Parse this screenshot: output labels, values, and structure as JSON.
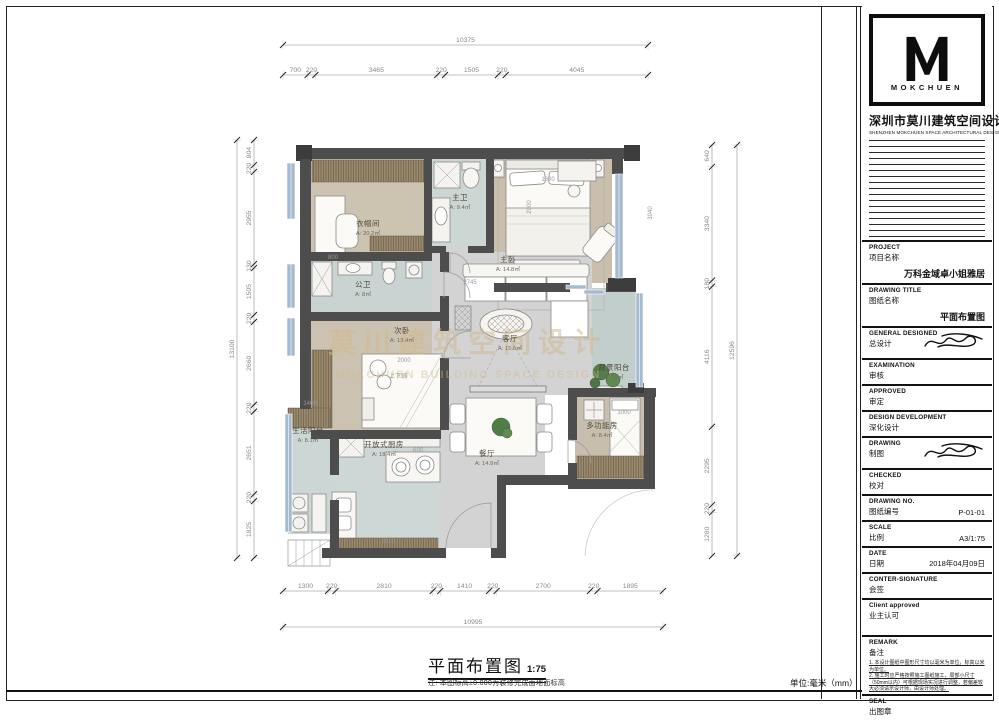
{
  "sheet": {
    "company": {
      "logo_letter": "M",
      "logo_word": "MOKCHUEN",
      "name_cn": "深圳市莫川建筑空间设计",
      "name_en": "SHENZHEN MOKCHUEN SPACE ARCHITECTURAL DESIGN"
    },
    "footer": {
      "title": "平面布置图",
      "scale": "1:75",
      "note": "注: 本图标高±0.000为装修完成面地面标高",
      "unit": "单位:毫米（mm）"
    },
    "watermark": {
      "cn": "莫川建筑空间设计",
      "en": "MOKCHUEN BUILDING SPACE DESIGN"
    },
    "colors": {
      "wall": "#4d4d4d",
      "bedroom_floor": "#cbc1ae",
      "wet_floor": "#ccd6d3",
      "living_floor": "#d3d3d4",
      "window_glass": "#a3bad0",
      "wood": "#9b8a6e",
      "watermark": "#d2b98b"
    }
  },
  "titleblock": {
    "rows": [
      {
        "en": "PROJECT",
        "cn": "项目名称",
        "value": "万科金域卓小姐雅居",
        "tall": true
      },
      {
        "en": "DRAWING TITLE",
        "cn": "图纸名称",
        "value": "平面布置图",
        "tall": true
      },
      {
        "en": "GENERAL  DESIGNED",
        "cn": "总设计",
        "value": "",
        "sig": true
      },
      {
        "en": "EXAMINATION",
        "cn": "审核",
        "value": ""
      },
      {
        "en": "APPROVED",
        "cn": "审定",
        "value": ""
      },
      {
        "en": "DESIGN DEVELOPMENT",
        "cn": "深化设计",
        "value": ""
      },
      {
        "en": "DRAWING",
        "cn": "制图",
        "value": "",
        "sig": true
      },
      {
        "en": "CHECKED",
        "cn": "校对",
        "value": ""
      },
      {
        "en": "DRAWING NO.",
        "cn": "图纸编号",
        "value": "P-01-01"
      },
      {
        "en": "SCALE",
        "cn": "比例",
        "value": "A3/1:75"
      },
      {
        "en": "DATE",
        "cn": "日期",
        "value": "2018年04月09日"
      },
      {
        "en": "CONTER-SIGNATURE",
        "cn": "会签",
        "value": ""
      },
      {
        "en": "Client approved",
        "cn": "业主认可",
        "value": "",
        "space": true
      }
    ],
    "remark": {
      "en": "REMARK",
      "cn": "备注",
      "notes": [
        "1. 本设计图纸中图形尺寸均以毫米为单位，标高以米为单位。",
        "2. 施工时应严格按照施工图纸施工，局部小尺寸（50mm以内）可根据现场实况进行调整，若偏差较大必须请示设计师，由设计师处理。"
      ]
    },
    "seal": {
      "en": "SEAL",
      "cn": "出图章"
    }
  },
  "plan": {
    "dims": {
      "top": {
        "total": "10375",
        "segments": [
          "700",
          "220",
          "3465",
          "220",
          "1505",
          "220",
          "4045"
        ]
      },
      "bottom": {
        "total": "10995",
        "segments": [
          "1300",
          "220",
          "2810",
          "220",
          "1410",
          "220",
          "2700",
          "220",
          "1895"
        ]
      },
      "left": {
        "total": "13100",
        "segments": [
          "804",
          "220",
          "2955",
          "130",
          "1505",
          "220",
          "2660",
          "220",
          "2651",
          "220",
          "1825"
        ]
      },
      "right": {
        "total": "12596",
        "segments": [
          "640",
          "3340",
          "180",
          "4116",
          "2295",
          "220",
          "1280"
        ]
      }
    },
    "rooms": [
      {
        "name": "衣帽间",
        "area": "A: 20.2㎡",
        "x": 368,
        "y": 226
      },
      {
        "name": "主卫",
        "area": "A: 9.4㎡",
        "x": 460,
        "y": 200
      },
      {
        "name": "主卧",
        "area": "A: 14.8㎡",
        "x": 508,
        "y": 262
      },
      {
        "name": "公卫",
        "area": "A: 8㎡",
        "x": 363,
        "y": 287
      },
      {
        "name": "次卧",
        "area": "A: 13.4㎡",
        "x": 402,
        "y": 333
      },
      {
        "name": "客厅",
        "area": "A: 15.6㎡",
        "x": 510,
        "y": 341
      },
      {
        "name": "观景阳台",
        "area": "A: 11㎡",
        "x": 614,
        "y": 370
      },
      {
        "name": "多功能房",
        "area": "A: 8.4㎡",
        "x": 602,
        "y": 428
      },
      {
        "name": "餐厅",
        "area": "A: 14.9㎡",
        "x": 487,
        "y": 456
      },
      {
        "name": "开放式厨房",
        "area": "A: 18.4㎡",
        "x": 384,
        "y": 447
      },
      {
        "name": "生活阳台",
        "area": "A: 8.1㎡",
        "x": 308,
        "y": 433
      }
    ],
    "inner_labels": [
      {
        "t": "3940",
        "x": 652,
        "y": 213,
        "r": -90
      },
      {
        "t": "1800",
        "x": 548,
        "y": 181,
        "r": 0
      },
      {
        "t": "2000",
        "x": 531,
        "y": 207,
        "r": -90
      },
      {
        "t": "2745",
        "x": 470,
        "y": 284,
        "r": 0
      },
      {
        "t": "2000",
        "x": 404,
        "y": 362,
        "r": 0
      },
      {
        "t": "上下铺",
        "x": 398,
        "y": 378,
        "r": 0
      },
      {
        "t": "1000",
        "x": 624,
        "y": 414,
        "r": 0
      },
      {
        "t": "2810",
        "x": 388,
        "y": 543,
        "r": 0
      },
      {
        "t": "800",
        "x": 333,
        "y": 259,
        "r": 0
      },
      {
        "t": "1400",
        "x": 310,
        "y": 405,
        "r": 0
      },
      {
        "t": "600",
        "x": 418,
        "y": 452,
        "r": 0
      }
    ]
  }
}
